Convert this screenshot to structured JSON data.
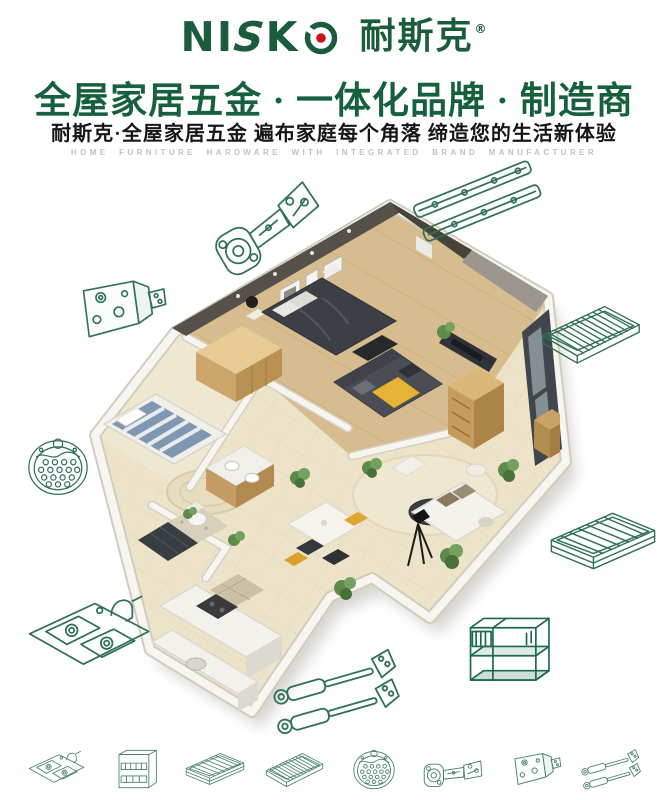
{
  "page": {
    "background": "#ffffff"
  },
  "header": {
    "logo": {
      "word_ni": "NI",
      "word_s": "S",
      "word_k": "K",
      "cn": "耐斯克",
      "reg": "®"
    },
    "headline": "全屋家居五金 · 一体化品牌 · 制造商",
    "subheadline": "耐斯克·全屋家居五金  遍布家庭每个角落  缔造您的生活新体验",
    "tagline": "HOME FURNITURE HARDWARE WITH INTEGRATED BRAND MANUFACTURER"
  },
  "colors": {
    "brand_green": "#1a5c3b",
    "logo_dot_red": "#c81414",
    "headline_green": "#17603d",
    "line_art_green": "#2f7156",
    "line_art_dark_green": "#1b6a4e",
    "tagline_gray": "#c3c2c0"
  },
  "hero": {
    "type": "apartment-3d-cutaway-render"
  },
  "floating_products": [
    {
      "name": "concealed-cabinet-hinge"
    },
    {
      "name": "ball-bearing-drawer-slides"
    },
    {
      "name": "cabinet-mounting-bracket"
    },
    {
      "name": "wire-shelf-rack"
    },
    {
      "name": "round-sink-drainer"
    },
    {
      "name": "pull-out-wire-basket"
    },
    {
      "name": "double-bowl-kitchen-sink"
    },
    {
      "name": "gas-lift-supports"
    },
    {
      "name": "kitchen-wire-organizer-rack"
    }
  ],
  "bottom_products": [
    {
      "name": "kitchen-sink"
    },
    {
      "name": "pull-out-cabinet-frame"
    },
    {
      "name": "drawer-basket"
    },
    {
      "name": "wire-tray"
    },
    {
      "name": "sink-drainer"
    },
    {
      "name": "cabinet-hinge"
    },
    {
      "name": "mounting-bracket"
    },
    {
      "name": "gas-struts"
    }
  ]
}
